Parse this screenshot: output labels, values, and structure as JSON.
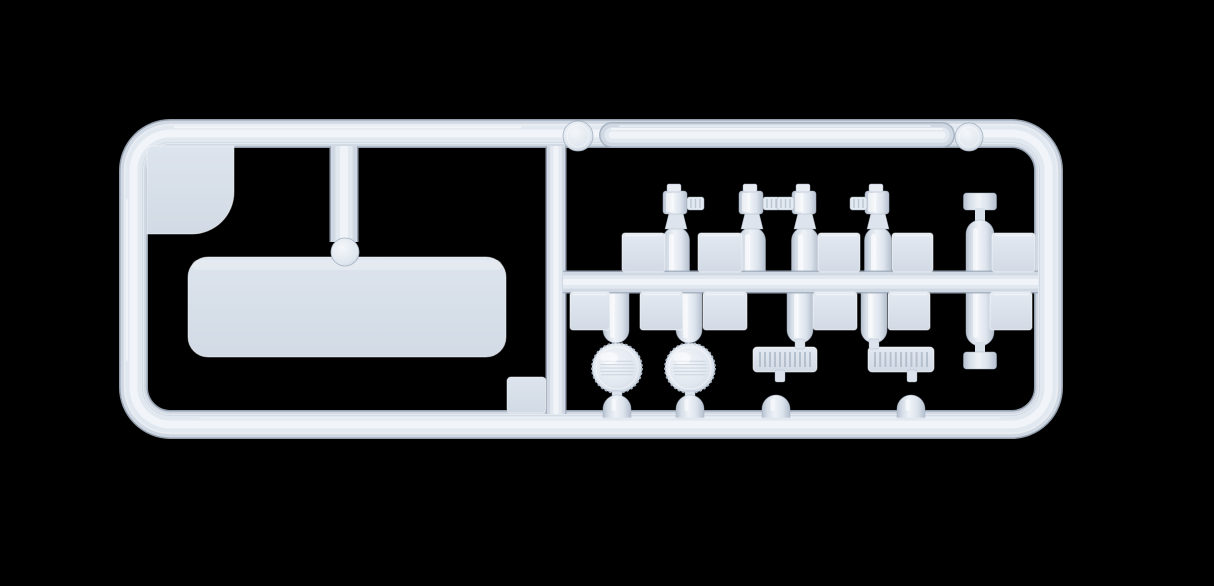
{
  "scene": {
    "subject": "injection-molded plastic model kit sprue (parts tree) of pale blue-grey styrene on a black background",
    "background": "#000000",
    "palette": {
      "edge": "#a3afbf",
      "mid": "#cfd8e3",
      "light": "#e2e8f0",
      "core": "#f1f5f9",
      "square_hi": "#e3e9f1",
      "square_lo": "#d2dae5",
      "panel_hi": "#dde4ee",
      "panel_lo": "#d2dae5",
      "cyl_dark": "#b4bfce",
      "cyl_mid": "#d5dde7",
      "cyl_light": "#eff3f8",
      "circle_center": "#f1f4f8",
      "circle_edge": "#c2cdda",
      "rim_white": "rgba(255,255,255,0.55)",
      "slat": "#aab6c5"
    }
  },
  "sprue": {
    "frame": {
      "cx": 133.5,
      "cy": 133.5,
      "cw": 915,
      "ch": 291,
      "corner_r": 37,
      "bar_w": 26
    },
    "runners": {
      "divider": {
        "x": 556,
        "y1": 146,
        "y2": 414,
        "w": 18
      },
      "left_feed": {
        "x": 344,
        "y1": 146,
        "y2": 242,
        "w": 26,
        "bulb": {
          "cx": 345,
          "cy": 252,
          "r": 14
        }
      },
      "middle": {
        "y": 282,
        "x1": 563,
        "x2": 1038,
        "w": 20
      }
    },
    "gate_knobs": [
      {
        "cx": 578,
        "cy": 136,
        "r": 15
      },
      {
        "cx": 969,
        "cy": 137,
        "r": 14
      }
    ],
    "parts": {
      "top_tube": {
        "x1": 612,
        "x2": 942,
        "y": 135,
        "w": 23
      },
      "corner_plate": {
        "x": 147,
        "y": 146,
        "w": 87,
        "h": 88,
        "br_r": 42
      },
      "large_panel": {
        "x": 188,
        "y": 257,
        "w": 318,
        "h": 100,
        "r": 20
      },
      "small_plate": {
        "x": 507,
        "y": 377,
        "w": 39,
        "h": 36,
        "r": 4
      },
      "valve_cylinders": [
        {
          "cx": 676,
          "spout": "right"
        },
        {
          "cx": 752,
          "spout": "right"
        },
        {
          "cx": 805,
          "spout": "left"
        },
        {
          "cx": 878,
          "spout": "left"
        }
      ],
      "cylinder_geom": {
        "body_w": 27,
        "body_top": 227,
        "body_bottom": 290,
        "valve_top": 184
      },
      "capsule_tank": {
        "cx": 980,
        "body_w": 28,
        "top": 220,
        "bottom": 346,
        "cap_w": 33,
        "cap_h": 17,
        "top_cap_y": 193,
        "bottom_cap_y": 352
      },
      "squares_top_row": {
        "y": 233,
        "h": 39,
        "items": [
          {
            "x": 622,
            "w": 43
          },
          {
            "x": 698,
            "w": 44
          },
          {
            "x": 818,
            "w": 42
          },
          {
            "x": 892,
            "w": 41
          },
          {
            "x": 992,
            "w": 43
          }
        ]
      },
      "squares_bottom_row": {
        "y": 292,
        "h": 38,
        "items": [
          {
            "x": 570,
            "w": 40
          },
          {
            "x": 640,
            "w": 43
          },
          {
            "x": 703,
            "w": 44
          },
          {
            "x": 813,
            "w": 44
          },
          {
            "x": 888,
            "w": 42
          },
          {
            "x": 990,
            "w": 42
          }
        ]
      },
      "drop_tubes": {
        "y1": 282,
        "y2": 330,
        "w": 26,
        "r": 13,
        "centers": [
          616,
          689,
          800,
          874
        ]
      },
      "knurled_caps": [
        {
          "cx": 617,
          "cy": 368,
          "r": 25
        },
        {
          "cx": 690,
          "cy": 368,
          "r": 25
        }
      ],
      "vent_grilles": [
        {
          "x": 753,
          "y": 347,
          "w": 64,
          "h": 25,
          "slats": 11
        },
        {
          "x": 868,
          "y": 347,
          "w": 66,
          "h": 25,
          "slats": 11
        }
      ],
      "grille_necks_top": [
        {
          "x": 795,
          "y": 339,
          "w": 10,
          "h": 10
        },
        {
          "x": 869,
          "y": 339,
          "w": 10,
          "h": 10
        }
      ],
      "grille_necks_bottom": [
        {
          "x": 775,
          "y": 370,
          "w": 10,
          "h": 12
        },
        {
          "x": 907,
          "y": 370,
          "w": 10,
          "h": 12
        }
      ],
      "cap_necks": [
        {
          "x": 612,
          "y": 391,
          "w": 10,
          "h": 8
        },
        {
          "x": 685,
          "y": 391,
          "w": 10,
          "h": 8
        }
      ],
      "bottom_gates": {
        "y_base": 418,
        "shoulder_y": 409,
        "w": 28,
        "centers": [
          617,
          690,
          776,
          911
        ]
      }
    }
  }
}
